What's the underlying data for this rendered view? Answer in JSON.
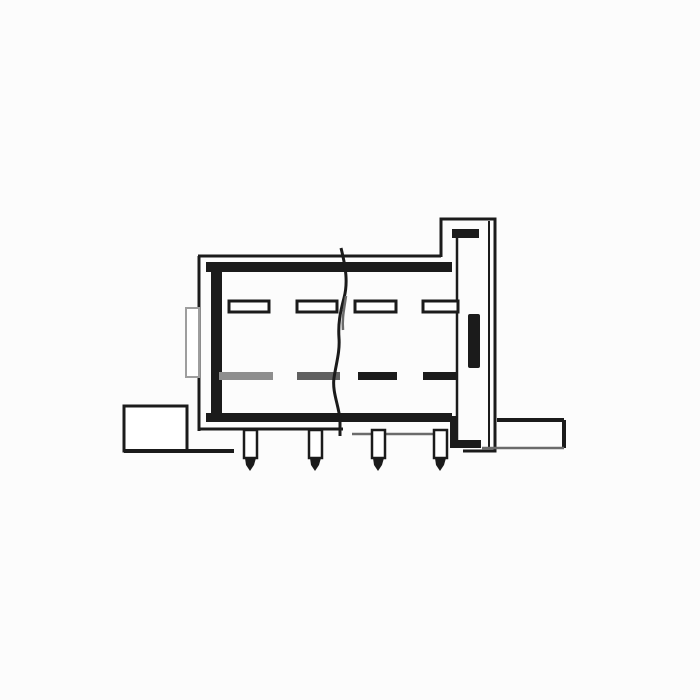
{
  "figure": {
    "kind": "technical-line-drawing",
    "subject": "connector-housing-side-section-view",
    "text_labels": []
  },
  "colors": {
    "ink": "#1b1b1b",
    "mid": "#6b6b6b",
    "light": "#9e9e9e",
    "paper": "#ffffff",
    "background": "#fcfcfc"
  },
  "contacts": {
    "top_row": {
      "y": 301,
      "height": 11,
      "slots": [
        {
          "x": 229,
          "width": 40
        },
        {
          "x": 297,
          "width": 40
        },
        {
          "x": 355,
          "width": 41
        },
        {
          "x": 423,
          "width": 35
        }
      ]
    },
    "bottom_row": {
      "y": 372,
      "height": 8,
      "bars": [
        {
          "x": 219,
          "width": 54,
          "color": "#8e8e8e"
        },
        {
          "x": 297,
          "width": 43,
          "color": "#606060"
        },
        {
          "x": 358,
          "width": 39,
          "color": "#1b1b1b"
        },
        {
          "x": 423,
          "width": 35,
          "color": "#1b1b1b"
        }
      ]
    }
  },
  "pins": {
    "count": 4,
    "top_y": 430,
    "body_height": 28,
    "width": 13,
    "tip_height": 13,
    "positions_x": [
      244,
      309,
      372,
      434
    ]
  }
}
